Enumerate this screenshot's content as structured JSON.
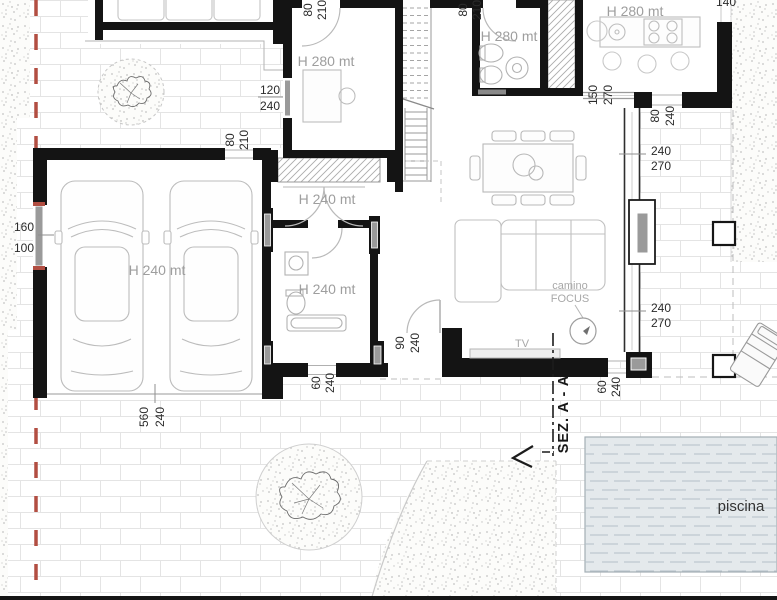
{
  "rooms": {
    "study": "H 280 mt",
    "bathroom": "H 280 mt",
    "kitchen": "H 280 mt",
    "garage": "H 240 mt",
    "hallway": "H 240 mt",
    "laundry": "H 240 mt"
  },
  "labels": {
    "fireplace_line1": "camino",
    "fireplace_line2": "FOCUS",
    "tv": "TV",
    "pool": "piscina",
    "section": "SEZ. A - A",
    "wall_dim_top": "140"
  },
  "dimensions": {
    "study_window": {
      "w": "120",
      "h": "240"
    },
    "study_door": {
      "w": "80",
      "h": "210"
    },
    "bath_door": {
      "w": "80",
      "h": "210"
    },
    "garage_side_door": {
      "w": "80",
      "h": "210"
    },
    "garage_window": {
      "w": "160",
      "h": "100"
    },
    "garage_door": {
      "w": "560",
      "h": "240"
    },
    "laundry_door": {
      "w": "60",
      "h": "240"
    },
    "entry_door": {
      "w": "90",
      "h": "240"
    },
    "south_window": {
      "w": "60",
      "h": "240"
    },
    "kitchen_opening": {
      "w": "80",
      "h": "240"
    },
    "north_window": {
      "w": "150",
      "h": "270"
    },
    "east_window_upper": {
      "w": "240",
      "h": "270"
    },
    "east_window_lower": {
      "w": "240",
      "h": "270"
    }
  },
  "colors": {
    "wall": "#141414",
    "boundary_red": "#b24e42",
    "pool_fill": "#e4e9ec",
    "glazing": "#9a9a9a"
  }
}
